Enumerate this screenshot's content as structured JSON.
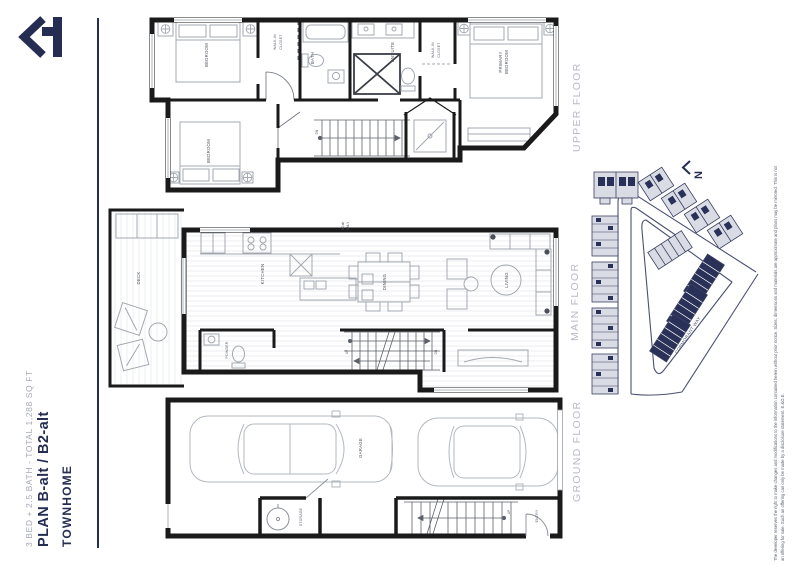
{
  "colors": {
    "navy": "#252e52",
    "wall": "#1a1a1a",
    "furniture_line": "#a3a8b0",
    "floor_label_gray": "#b7bbc6",
    "building_gray": "#d9dce4",
    "building_navy": "#2a3158",
    "street_line": "#4a5170"
  },
  "logo": {
    "name": "brand-mark"
  },
  "title_block": {
    "brand": "TOWNHOME",
    "plan": "PLAN B-alt / B2-alt",
    "specs": "3 BED + 2.5 BATH - TOTAL 1,288 SQ FT"
  },
  "floors": {
    "upper": {
      "label": "UPPER FLOOR",
      "rooms": {
        "bedroom1": "BEDROOM",
        "bedroom2": "BEDROOM",
        "bath": "BATH",
        "ensuite": "ENSUITE",
        "wic_top_l1": "WALK-IN",
        "wic_top_l2": "CLOSET",
        "wic2_l1": "WALK-IN",
        "wic2_l2": "CLOSET",
        "primary_l1": "PRIMARY",
        "primary_l2": "BEDROOM",
        "stair_dn": "DN"
      }
    },
    "main": {
      "label": "MAIN FLOOR",
      "note_l1": "B2-alt",
      "note_l2": "ONLY",
      "rooms": {
        "deck": "DECK",
        "kitchen": "KITCHEN",
        "dining": "DINING",
        "living": "LIVING",
        "powder": "POWDER",
        "stair_up": "UP",
        "stair_dn": "DN"
      }
    },
    "ground": {
      "label": "GROUND FLOOR",
      "rooms": {
        "garage": "GARAGE",
        "storage": "STORAGE",
        "entry": "ENTRY",
        "stair_up": "UP"
      }
    }
  },
  "site_map": {
    "north": "N",
    "street": "CORMORANT WAY"
  },
  "disclaimer": {
    "line1": "The developer reserves the right to make changes and modifications to the information contained herein without prior notice. Sizes, dimensions and materials are approximate and plans may be mirrored. This is not",
    "line2": "an offering for sale. Such an offering can only be made by a disclosure statement. E.&O.E."
  }
}
